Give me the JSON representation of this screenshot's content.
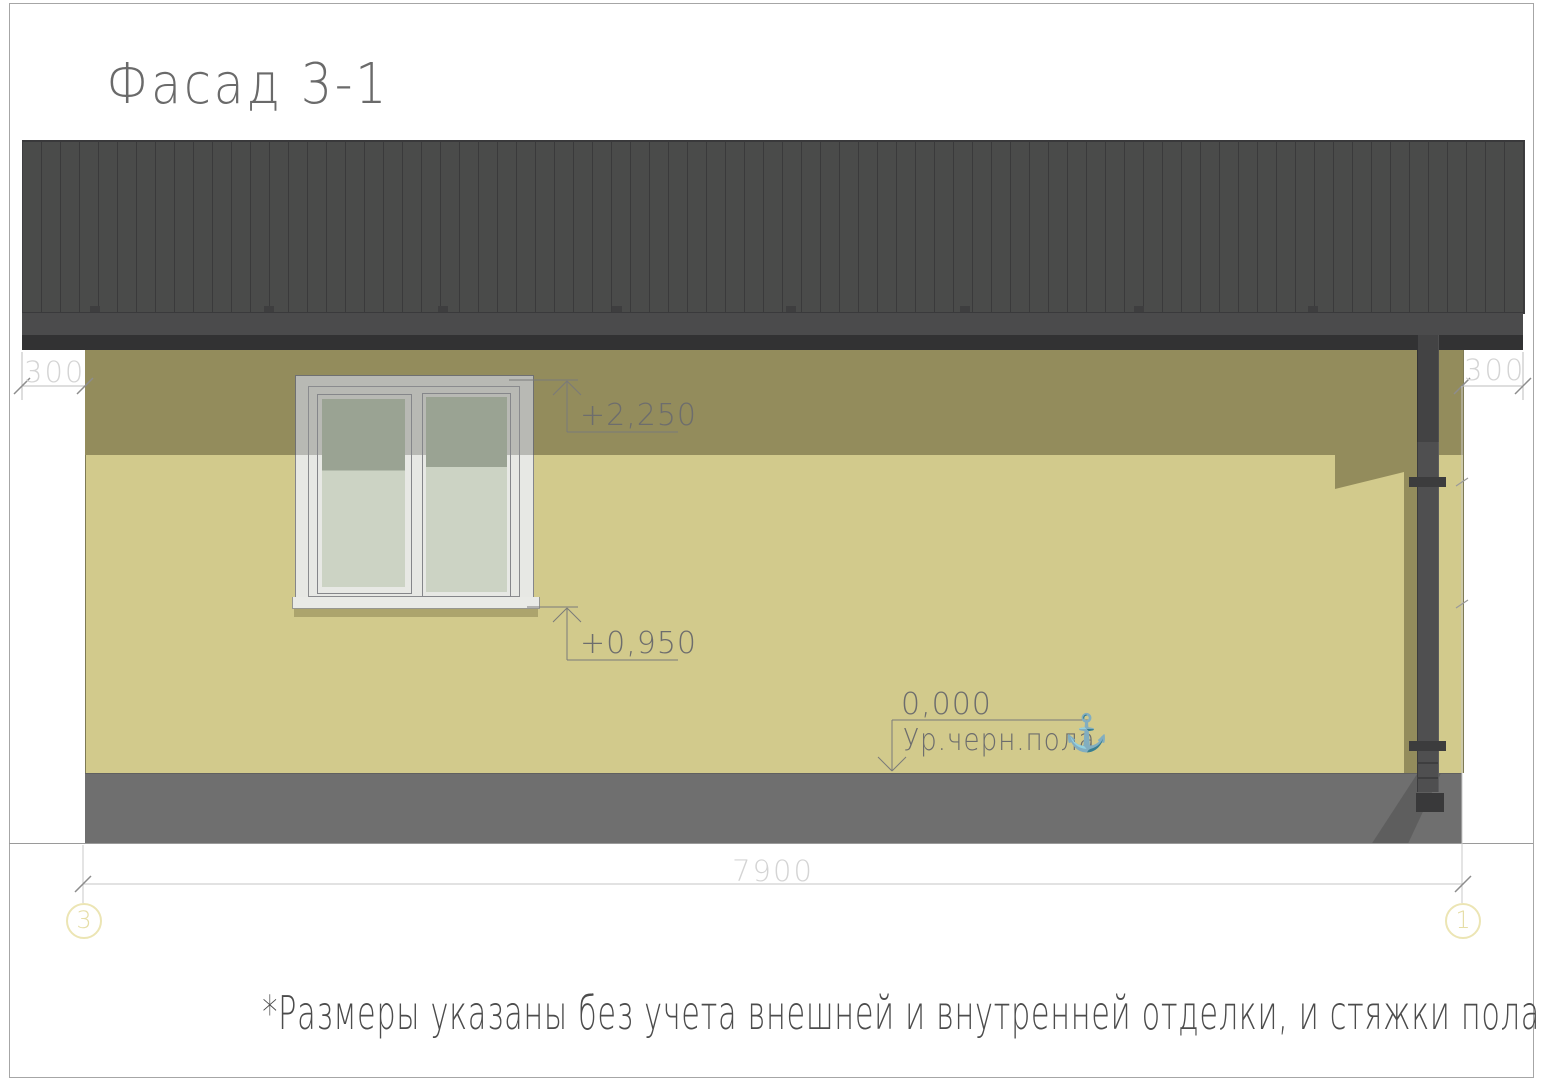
{
  "title": "Фасад 3-1",
  "footnote": "*Размеры указаны без учета внешней и внутренней отделки, и стяжки пола.",
  "dimensions": {
    "left_overhang": "300",
    "right_overhang": "300",
    "total_width": "7900"
  },
  "levels": {
    "window_head": {
      "value": "+2,250"
    },
    "window_sill": {
      "value": "+0,950"
    },
    "floor": {
      "value": "0,000",
      "label": "Ур.черн.пола"
    }
  },
  "axes": {
    "left": "3",
    "right": "1"
  },
  "icons": {
    "anchor": "⚓"
  },
  "colors": {
    "roof": "#4a4b4a",
    "roof_rib": "#3a3a3b",
    "fascia": "#323233",
    "wall": "#d2ca8c",
    "wall_shadow": "#938c5c",
    "plinth": "#6f6f6f",
    "plinth_shadow": "#5e5e5e",
    "window_frame": "#e7e8e4",
    "glass_light": "#ccd3c4",
    "glass_shadow": "#9aa393",
    "downpipe": "#4f4f50",
    "dim_text": "#d4d4d4",
    "level_text": "#6d6d6d",
    "axis_bubble": "#ece5b4"
  }
}
